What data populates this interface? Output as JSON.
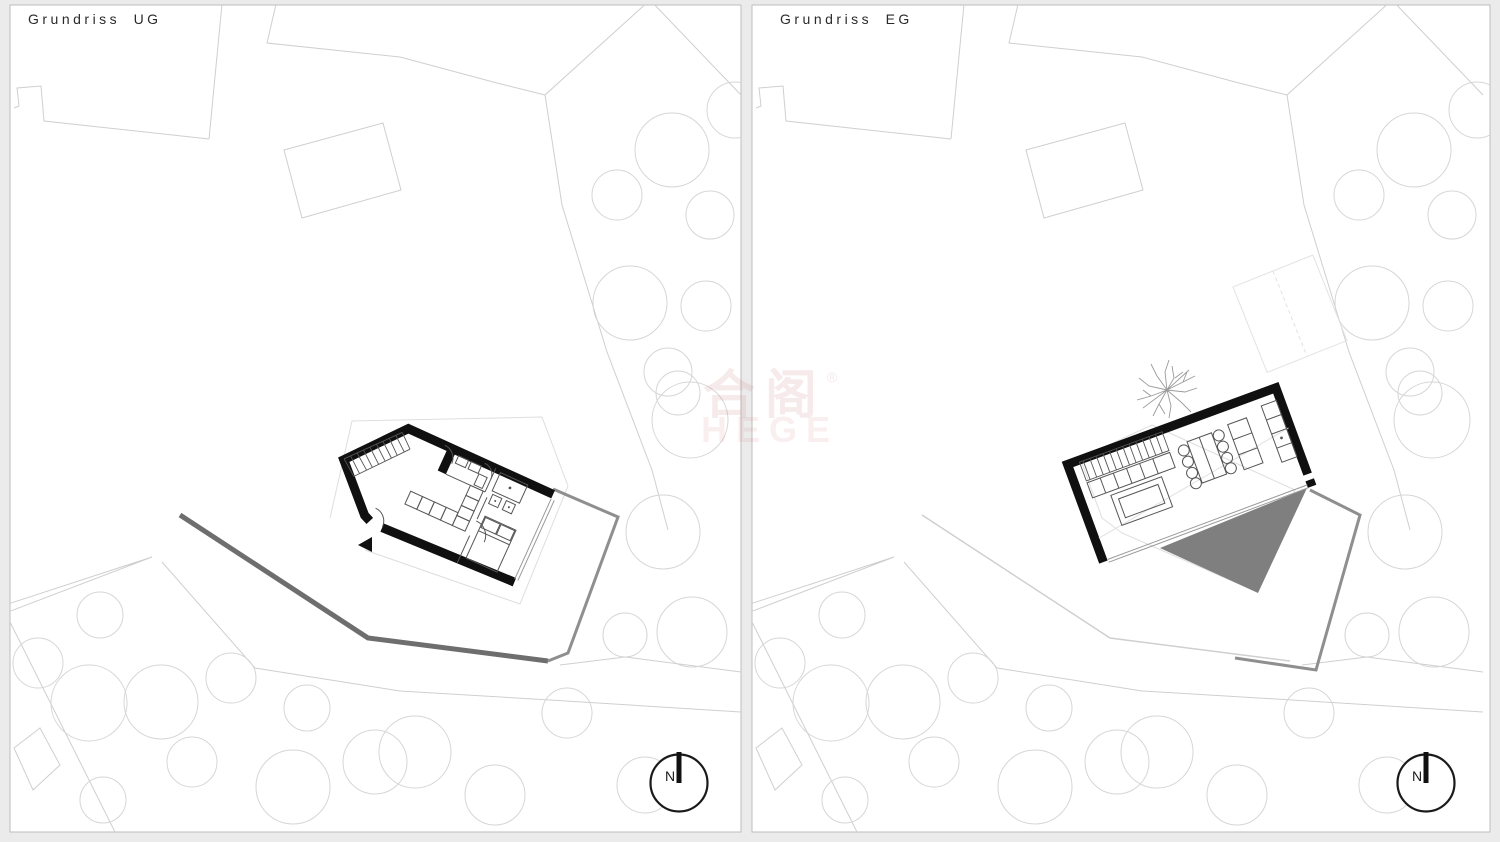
{
  "page": {
    "background": "#ebebeb"
  },
  "panels": [
    {
      "id": "ug",
      "title": "Grundriss UG",
      "compass_label": "N"
    },
    {
      "id": "eg",
      "title": "Grundriss EG",
      "compass_label": "N"
    }
  ],
  "watermark": {
    "cjk": "合阁",
    "registered": "®",
    "latin": "HEGE"
  },
  "colors": {
    "wall": "#101010",
    "site_line": "#cfcfcf",
    "tree_line": "#d6d6d6",
    "faint_line": "#dedede",
    "dark_path": "#6e6e6e",
    "terrace_wall": "#8f8f8f",
    "terrace_fill": "#7f7f7f",
    "panel_border": "#bdbdbd",
    "interior_line": "#555555",
    "glass_line": "#9a9a9a",
    "title_text": "#2a2a2a",
    "watermark_pink": "#ca7e7e"
  }
}
